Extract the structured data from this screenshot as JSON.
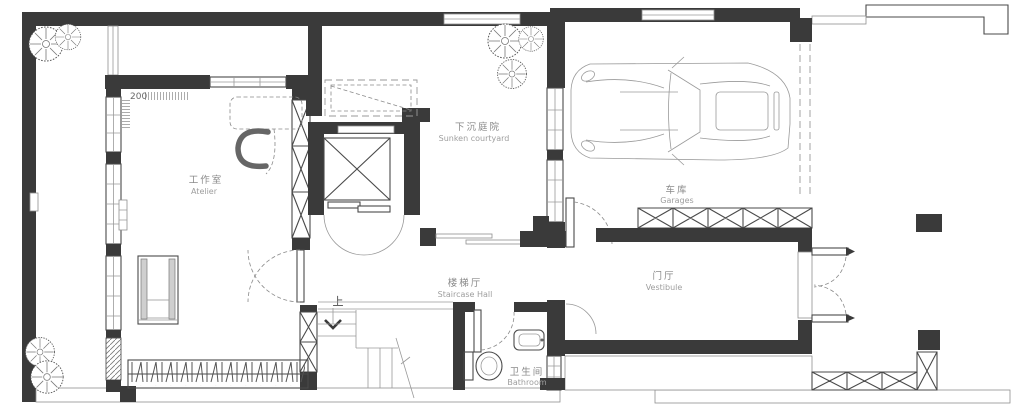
{
  "colors": {
    "wall": "#3a3a3a",
    "line": "#4a4a4a",
    "light_line": "#9a9a9a",
    "label_zh": "#8a8a8a",
    "label_en": "#9e9e9e",
    "background": "#ffffff"
  },
  "rooms": {
    "atelier": {
      "zh": "工作室",
      "en": "Atelier"
    },
    "courtyard": {
      "zh": "下沉庭院",
      "en": "Sunken  courtyard"
    },
    "garage": {
      "zh": "车库",
      "en": "Garages"
    },
    "staircase": {
      "zh": "楼梯厅",
      "en": "Staircase  Hall"
    },
    "vestibule": {
      "zh": "门厅",
      "en": "Vestibule"
    },
    "bathroom": {
      "zh": "卫生间",
      "en": "Bathroom"
    }
  },
  "annotations": {
    "dimension": "200",
    "stair_up": "上"
  },
  "symbols": {
    "car": "car-top-view",
    "plant": "shrub-plan-symbol",
    "elevator": "elevator-shaft-x",
    "x_brace": "crossed-storage-unit",
    "hatch_column": "hatched-masonry-column"
  }
}
